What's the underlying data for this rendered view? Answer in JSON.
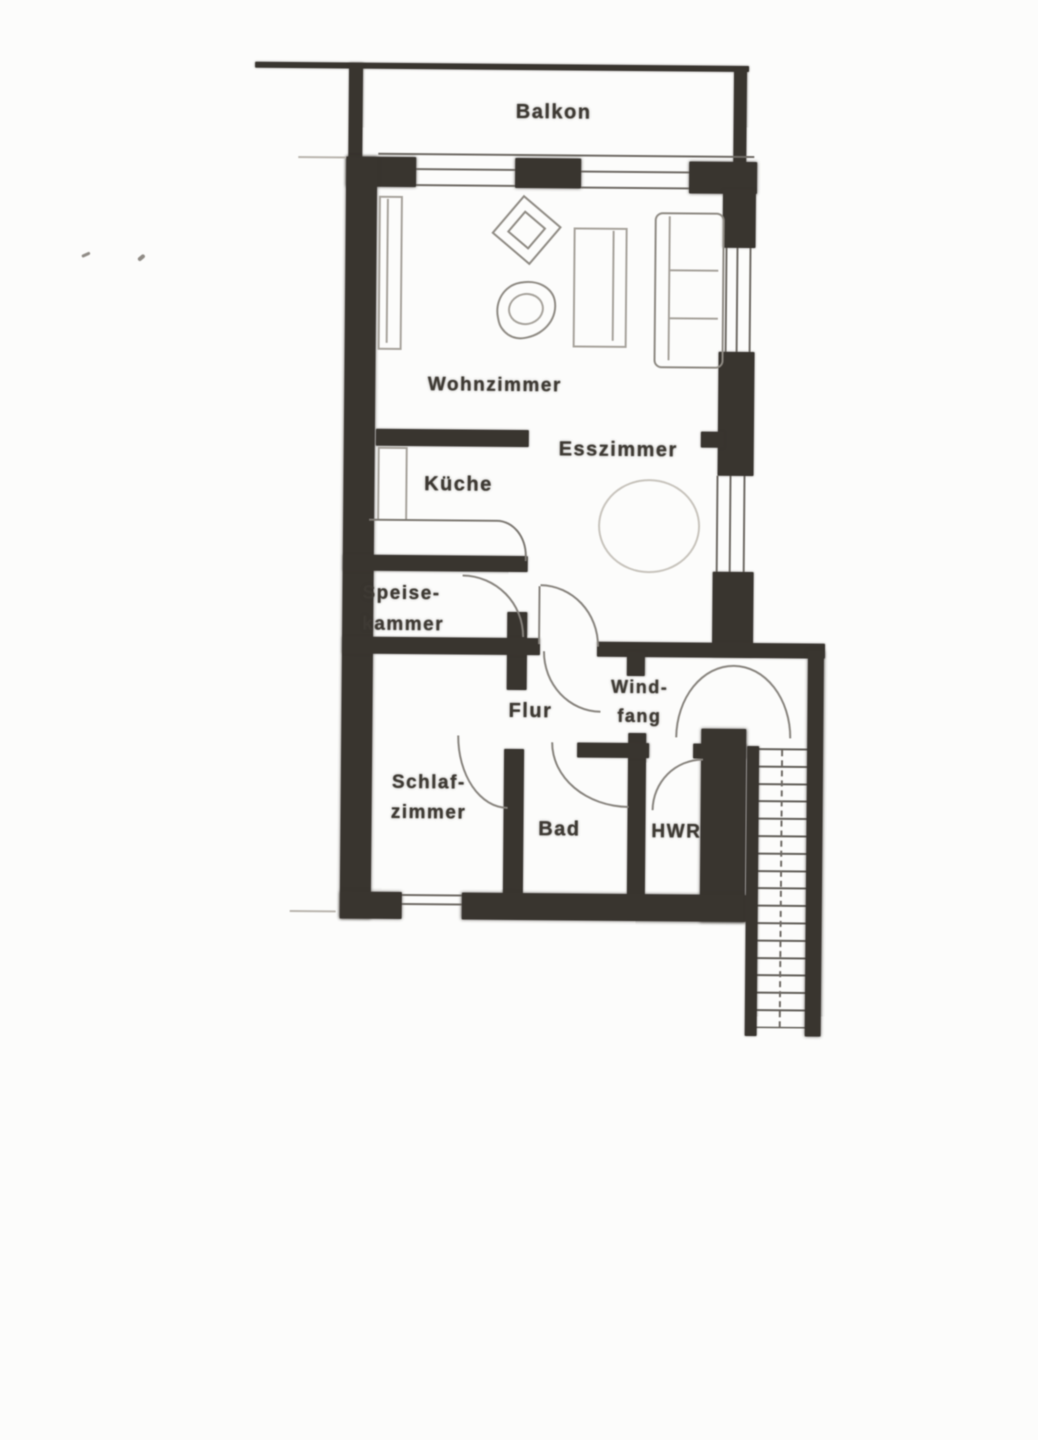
{
  "document_kind": "scanned apartment floor plan",
  "rooms": {
    "balkon": {
      "label": "Balkon"
    },
    "wohnzimmer": {
      "label": "Wohnzimmer"
    },
    "esszimmer": {
      "label": "Esszimmer"
    },
    "kueche": {
      "label": "Küche"
    },
    "speisekammer": {
      "line1": "Speise-",
      "line2": "kammer"
    },
    "flur": {
      "label": "Flur"
    },
    "windfang": {
      "line1": "Wind-",
      "line2": "fang"
    },
    "schlafzimmer": {
      "line1": "Schlaf-",
      "line2": "zimmer"
    },
    "bad": {
      "label": "Bad"
    },
    "hwr": {
      "label": "HWR"
    }
  },
  "colors": {
    "wall": "#3a3631",
    "furniture_line": "#8e8a83",
    "text": "#3f3b35",
    "paper": "#fcfcfb"
  }
}
